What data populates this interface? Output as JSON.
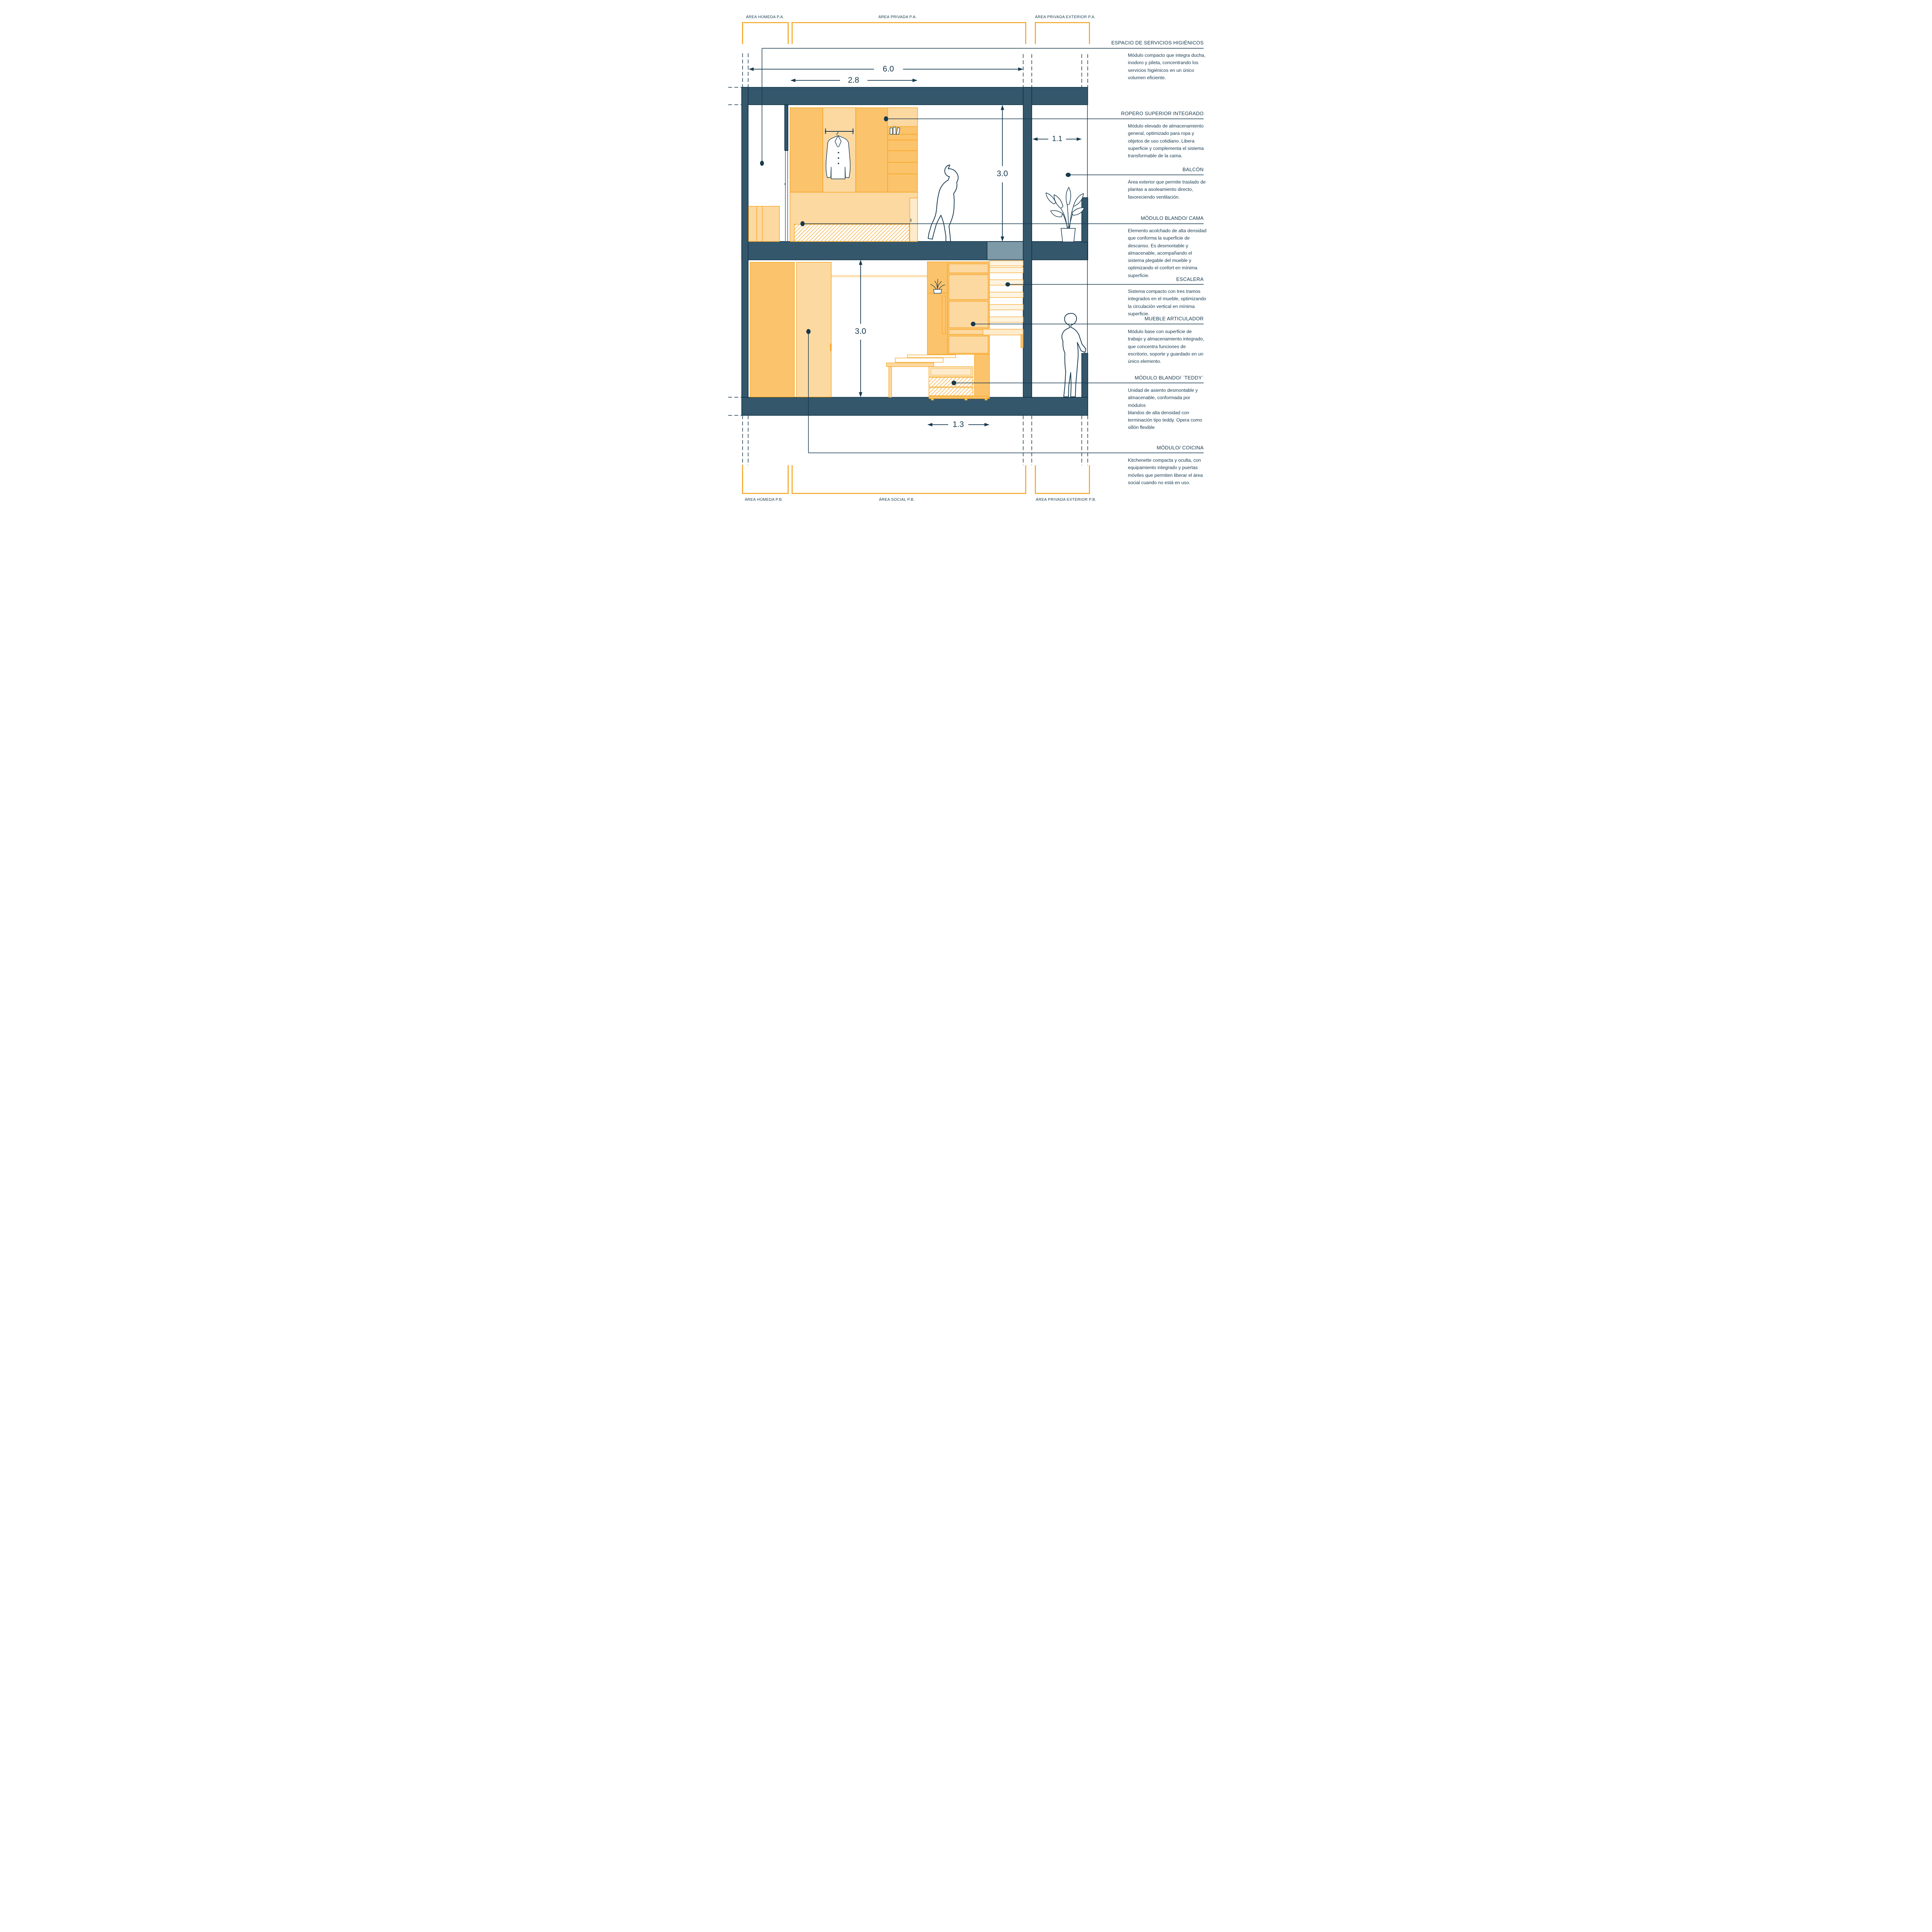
{
  "drawing_title": "Vivienda mínima — corte transversal con módulos transformables",
  "area_labels": {
    "top": [
      {
        "label": "ÁREA HÚMEDA P.A."
      },
      {
        "label": "ÁREA PRIVADA P.A."
      },
      {
        "label": "ÁREA PRIVADA EXTERIOR P.A."
      }
    ],
    "bottom": [
      {
        "label": "ÁREA HÚMEDA P.B."
      },
      {
        "label": "ÁREA SOCIAL P.B."
      },
      {
        "label": "ÁREA PRIVADA EXTERIOR P.B."
      }
    ]
  },
  "dimensions": {
    "overall_width_m": "6.0",
    "wardrobe_width_m": "2.8",
    "upper_floor_height_m": "3.0",
    "balcony_width_m": "1.1",
    "lower_floor_height_m": "3.0",
    "module_width_m": "1.3"
  },
  "annotations": [
    {
      "title": "ESPACIO DE SERVICIOS HIGIÉNICOS",
      "body": "Módulo compacto que integra ducha,\ninodoro y pileta, concentrando los\nservicios higiénicos en un único\nvolumen eficiente."
    },
    {
      "title": "ROPERO SUPERIOR INTEGRADO",
      "body": "Módulo elevado de almacenamiento\ngeneral, optimizado para ropa y\nobjetos de uso cotidiano. Libera\nsuperficie y complementa el sistema\ntransformable de la cama."
    },
    {
      "title": "BALCÓN",
      "body": "Área exterior que permite traslado de\nplantas a asoleamiento directo,\nfavoreciendo ventilación."
    },
    {
      "title": "MÓDULO BLANDO/ CAMA",
      "body": "Elemento acolchado de alta densidad\nque conforma la superficie de\ndescanso. Es desmontable y\nalmacenable, acompañando el\nsistema plegable del mueble y\noptimizando el confort en mínima\nsuperficie."
    },
    {
      "title": "ESCALERA",
      "body": "Sistema compacto con tres tramos\nintegrados en el mueble, optimizando\nla circulación vertical en mínima\nsuperficie."
    },
    {
      "title": "MUEBLE ARTICULADOR",
      "body": "Módulo base con superficie de\ntrabajo y almacenamiento integrado,\nque concentra funciones de\nescritorio, soporte y guardado en un\núnico elemento."
    },
    {
      "title": "MÓDULO BLANDO/ ¨TEDDY¨",
      "body": "Unidad de asiento desmontable y\nalmacenable, conformada por módulos\nblandos de alta densidad con\nterminación tipo teddy. Opera como\nsillón flexible"
    },
    {
      "title": "MÓDULO/ COICINA",
      "body": "Kitchenette compacta y oculta, con\nequipamiento integrado y puertas\nmóviles que permiten liberar el área\nsocial cuando no está en uso."
    }
  ],
  "icons": [
    "hanging-jacket-icon",
    "books-icon",
    "balcony-plant-icon",
    "shelf-plant-icon",
    "walking-person-figure",
    "standing-person-figure"
  ],
  "colors": {
    "structure_slate": "#34576C",
    "structure_gray": "#7E99A7",
    "furniture_orange": "#F5A41F",
    "furniture_fill_medium": "#FBC36B",
    "furniture_fill_light": "#FDD9A2",
    "ink_navy": "#16394E"
  }
}
